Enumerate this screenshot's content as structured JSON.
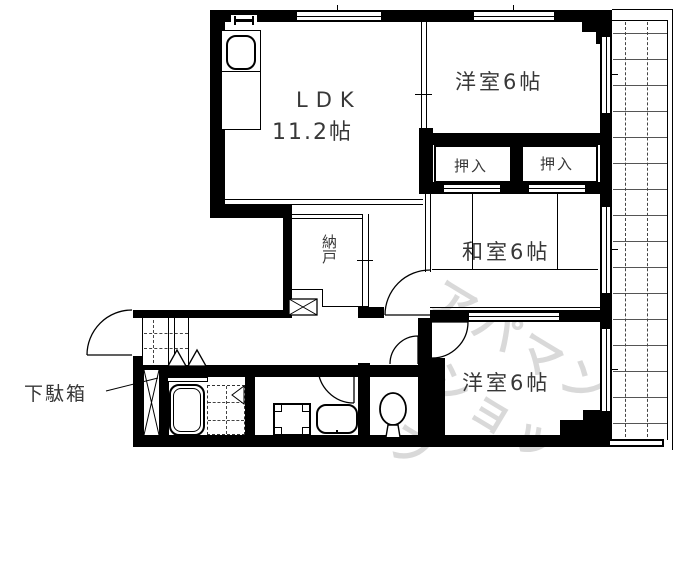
{
  "plan": {
    "title": "apartment-floor-plan",
    "rooms": {
      "ldk": {
        "name": "LDK",
        "size": "11.2帖"
      },
      "western_top": {
        "label": "洋室6帖"
      },
      "closet_left": {
        "label": "押入"
      },
      "closet_right": {
        "label": "押入"
      },
      "japanese": {
        "label": "和室6帖"
      },
      "storage": {
        "label": "納戸"
      },
      "western_bottom": {
        "label": "洋室6帖"
      },
      "shoe_cabinet": {
        "label": "下駄箱"
      }
    },
    "watermark": {
      "line1": "アパマン",
      "line2": "ショップ"
    },
    "colors": {
      "line": "#000000",
      "label": "#383838",
      "watermark": "#d9d9d9"
    }
  }
}
